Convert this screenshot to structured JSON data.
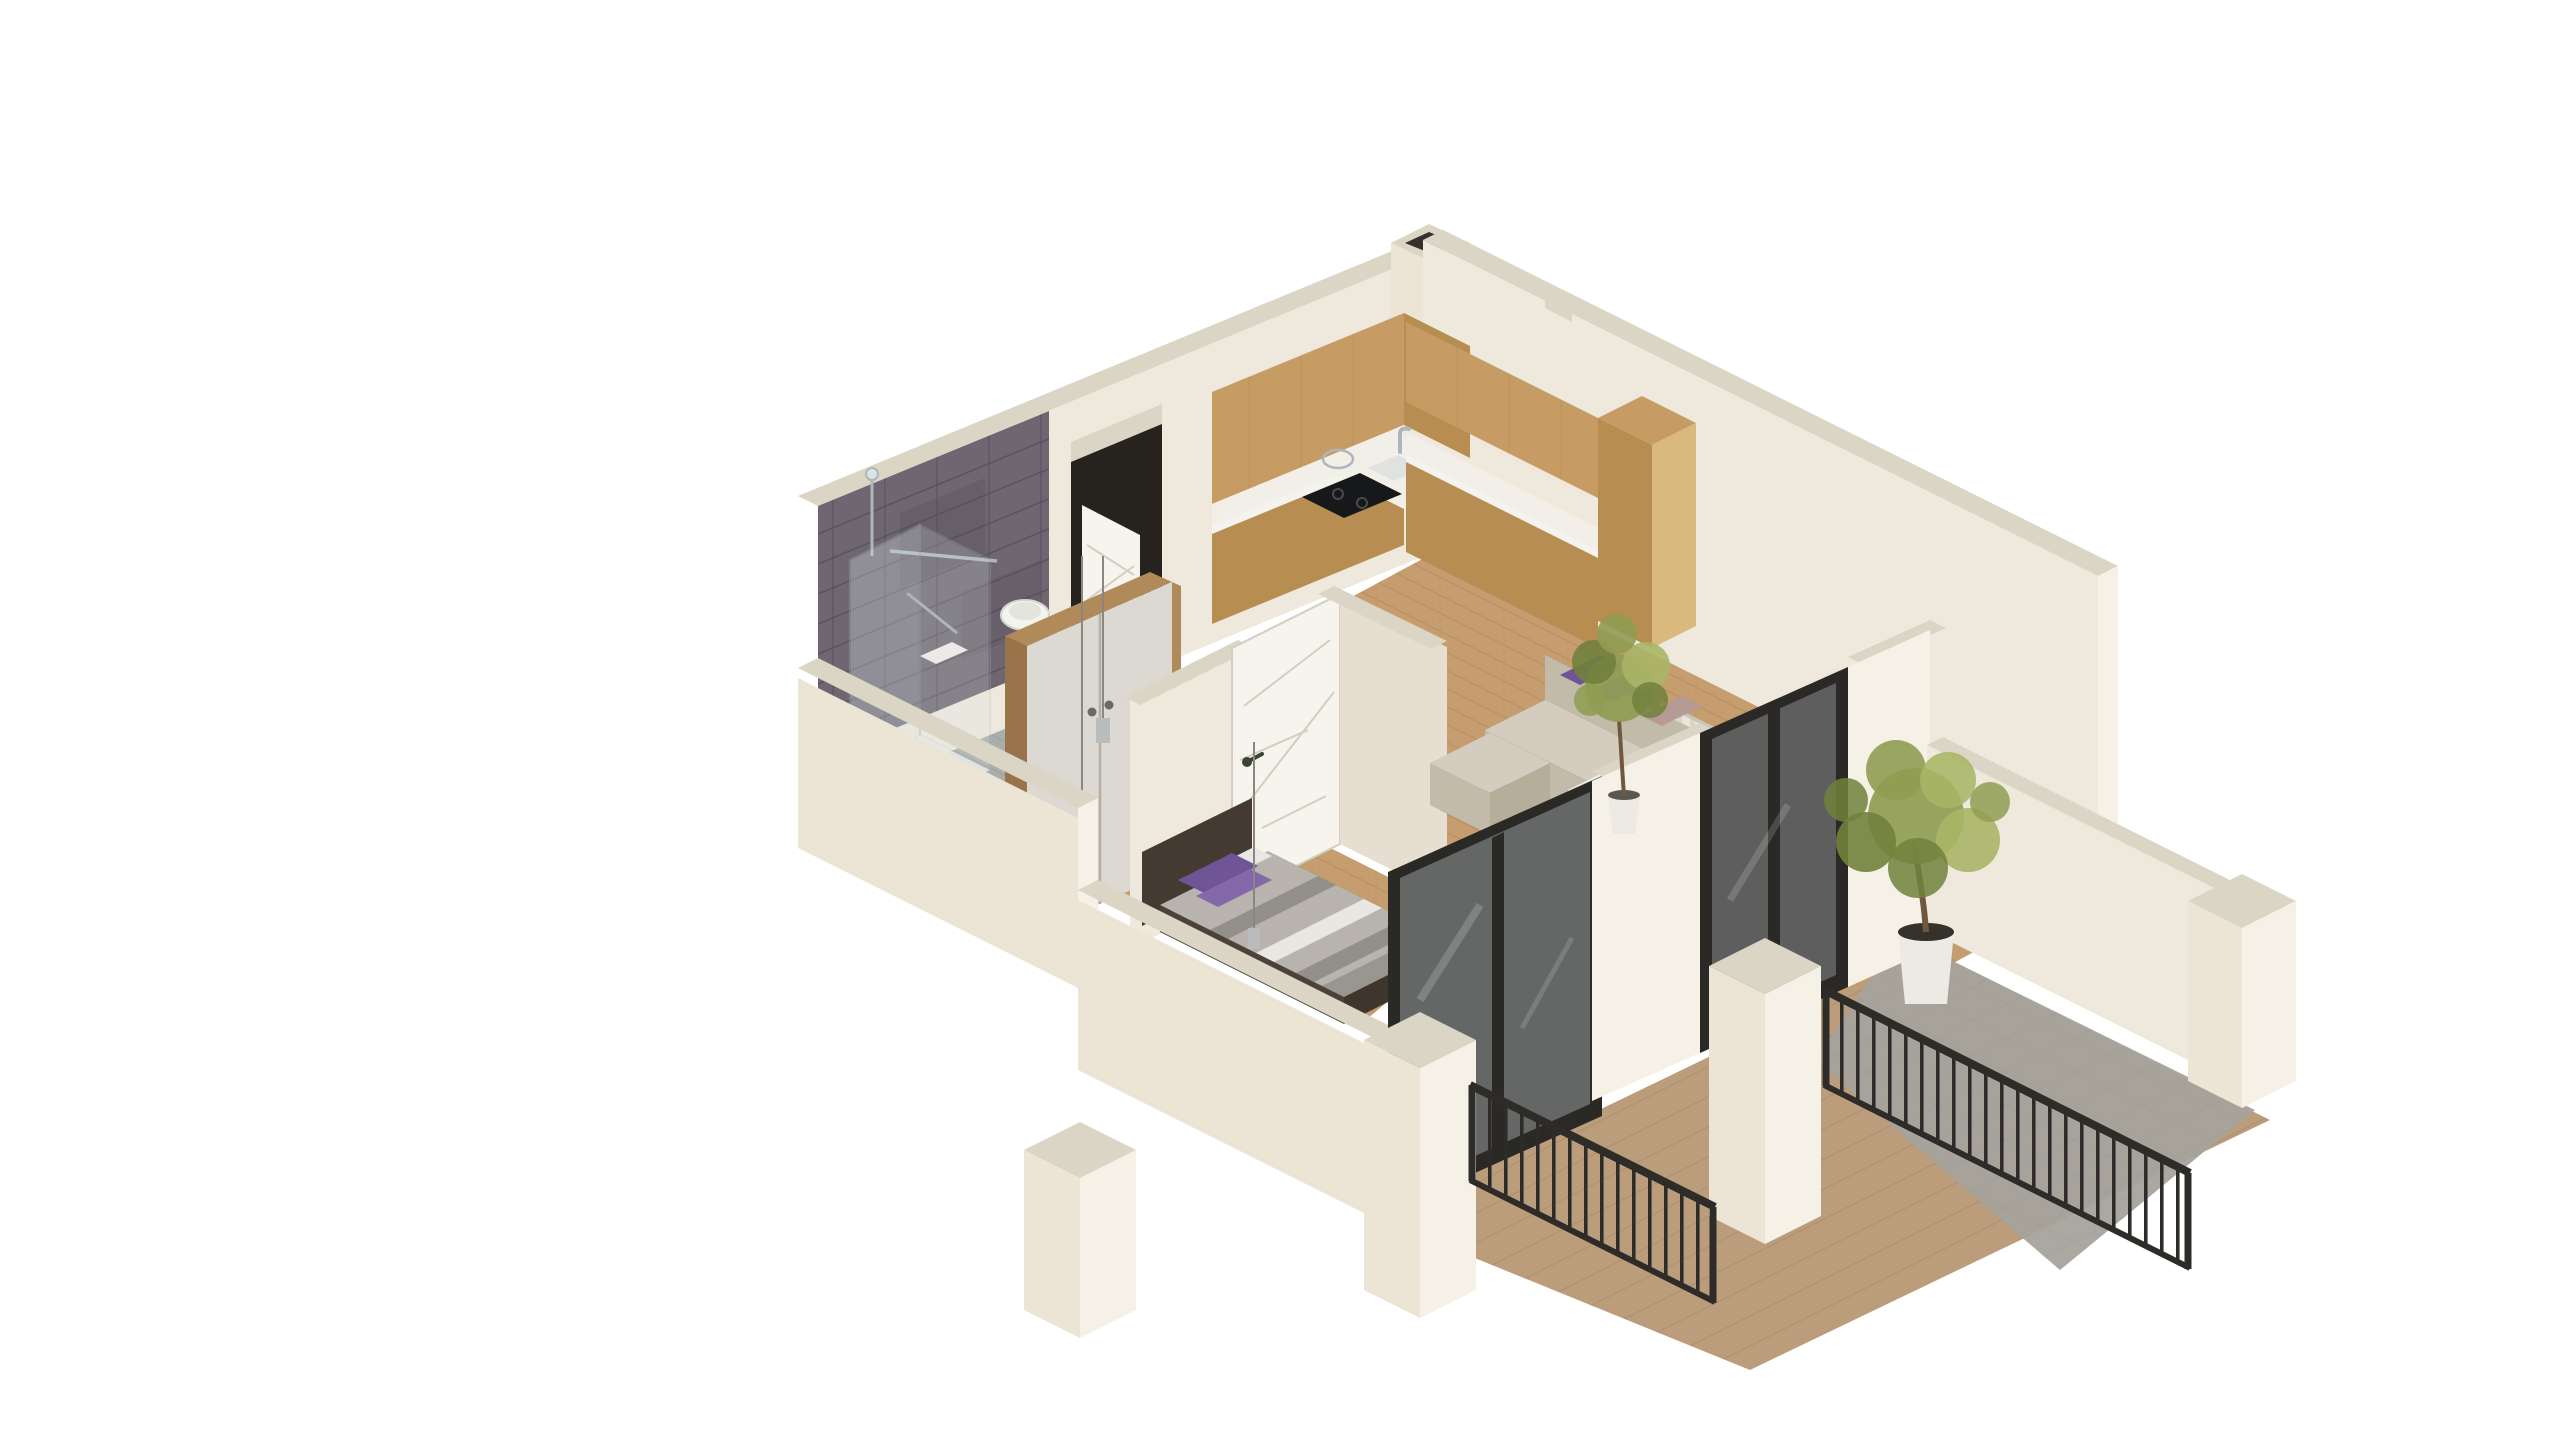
{
  "image": {
    "width": 2560,
    "height": 1440,
    "background": "#ffffff",
    "kind": "isometric-3d-floorplan-render"
  },
  "palette": {
    "bg": "#ffffff",
    "wallFace": "#efe9dd",
    "wallFaceShade": "#e6dfd1",
    "wallTop": "#dbd5c6",
    "wallBright": "#f6f1e7",
    "wallExt": "#ece5d6",
    "tile": "#6e6671",
    "tileDark": "#5d5560",
    "grout": "#524b56",
    "bathFloor": "#a9aeaa",
    "glass": "#d9e4e4",
    "chrome": "#aeb6ba",
    "white": "#f4f3ee",
    "wood": "#c69c64",
    "woodDark": "#b78d52",
    "woodSide": "#dab97f",
    "counter": "#f1efe7",
    "cooktop": "#17181a",
    "doorDark": "#26221e",
    "doorWhite": "#f6f4ed",
    "lineGray": "#d3cec2",
    "wardrobe": "#dcd9d2",
    "wardrobeWood": "#b08a58",
    "wardrobeWoodDark": "#99744a",
    "knob": "#6f6a61",
    "floorWood": "#c59d6e",
    "floorLine": "#b1875a",
    "deckWood": "#bb9d7b",
    "deckGray": "#a6a39c",
    "deckLine": "#a08a6d",
    "rug": "#4e3e7a",
    "rugLight": "#63539a",
    "sofa": "#d4cdbf",
    "sofaShade": "#c3bbaa",
    "sofaDark": "#b6ad9b",
    "pillowPurple": "#6f5496",
    "pillowPurple2": "#8468aa",
    "pillowMauve": "#b59b93",
    "pillowMauve2": "#a28b83",
    "table": "#edebe5",
    "tableSide": "#dedcd4",
    "tableSide2": "#d3d1c9",
    "bedGray": "#b8b4ad",
    "bedStripe": "#939089",
    "bedWhite": "#e9e7e2",
    "bedFrame": "#4d4238",
    "bedFrameDark": "#3e352c",
    "headboard": "#443a31",
    "railing": "#2e2c29",
    "frameBlack": "#2b2926",
    "glassTint": "#cfdcdd",
    "leaf": "#8f9c52",
    "leafDark": "#71813c",
    "leafLight": "#a8b566",
    "trunk": "#6f583f",
    "pot": "#eceae2",
    "soil": "#35322c",
    "radiator": "#e9e6dc",
    "radiatorFin": "#d9d5c9",
    "pendant": "#b9bcbd"
  },
  "scene": {
    "style": "isometric cutaway apartment render, white background, cream walls",
    "rooms": [
      {
        "name": "bathroom",
        "position": "upper-left",
        "items": [
          "dark-stone-tiled-wall",
          "glass-shower",
          "wall-hung-toilet",
          "towel-bar",
          "floor-mat"
        ]
      },
      {
        "name": "entrance-hall",
        "position": "upper-center",
        "items": [
          "dark-entrance-door",
          "open-white-door-leaf",
          "wardrobe",
          "pendant-lights"
        ]
      },
      {
        "name": "kitchen",
        "position": "top-center",
        "items": [
          "l-shaped-wood-cabinets",
          "white-countertop",
          "sink-with-faucet",
          "black-cooktop",
          "tall-cabinet-column"
        ]
      },
      {
        "name": "living-room",
        "position": "right",
        "items": [
          "corner-sofa",
          "purple-and-mauve-cushions",
          "purple-rug",
          "marble-coffee-table",
          "radiator",
          "tall-potted-plant"
        ]
      },
      {
        "name": "bedroom",
        "position": "lower-left",
        "items": [
          "double-bed",
          "gray-striped-duvet",
          "purple-pillows",
          "dark-headboard",
          "interior-white-door",
          "pendant-light"
        ]
      },
      {
        "name": "balcony",
        "position": "lower-right",
        "items": [
          "black-framed-glass-door-bedroom",
          "black-framed-glass-door-living",
          "wood-tile-deck",
          "metal-railings",
          "white-parapet-piers",
          "olive-tree-in-pot",
          "potted-deck-plant",
          "vent-chimney-block"
        ]
      }
    ]
  }
}
